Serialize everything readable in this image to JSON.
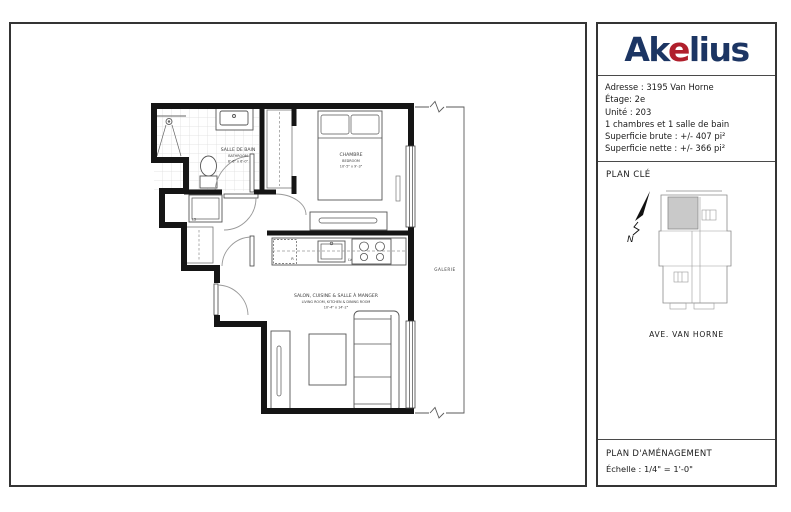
{
  "colors": {
    "logo_navy": "#1c3563",
    "logo_red": "#b01f2c",
    "wall_black": "#151515",
    "keyplan_unit_fill": "#c9c9c9"
  },
  "logo": {
    "pre": "Ak",
    "e": "e",
    "post": "lius"
  },
  "info": {
    "lines": [
      "Adresse : 3195 Van Horne",
      "Étage: 2e",
      "Unité : 203",
      "1 chambres et 1 salle de bain",
      "Superficie brute : +/- 407 pi²",
      "Superficie nette : +/- 366 pi²"
    ]
  },
  "plan_cle": {
    "title": "PLAN CLÉ",
    "north_label": "N",
    "street_label": "AVE. VAN HORNE"
  },
  "footer": {
    "title": "PLAN D'AMÉNAGEMENT",
    "scale": "Échelle : 1/4\" = 1'-0\""
  },
  "floor_plan": {
    "bathroom": {
      "name_fr": "SALLE DE BAIN",
      "name_en": "BATHROOM",
      "dims": "8'-6\" x 6'-0\""
    },
    "bedroom": {
      "name_fr": "CHAMBRE",
      "name_en": "BEDROOM",
      "dims": "10'-5\" x 9'-3\""
    },
    "living": {
      "name_fr": "SALON, CUISINE & SALLE À MANGER",
      "name_en": "LIVING ROOM, KITCHEN & DINING ROOM",
      "dims": "10'-4\" x 14'-2\""
    },
    "balcony_label": "GALERIE",
    "washer_label": "LS",
    "fridge_label": "R",
    "dishwasher_label": "LV"
  }
}
